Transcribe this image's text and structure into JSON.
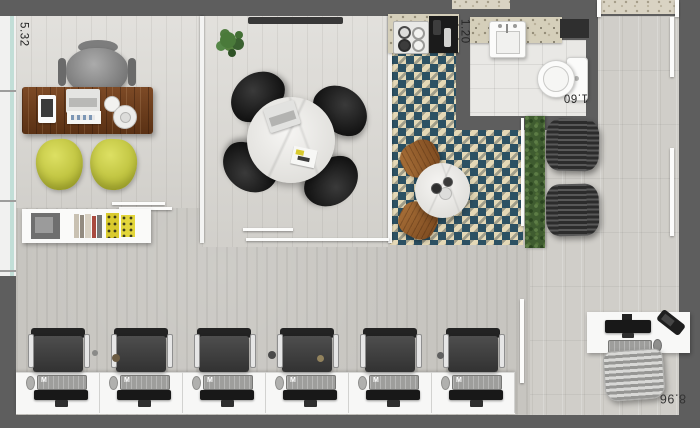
{
  "plan": {
    "type": "office-floorplan",
    "dimensions": {
      "left_room_depth": "5.32",
      "bath_width": "1.20",
      "bath_length": "1.60",
      "bottom_width": "8.96"
    },
    "workstation": {
      "count": 6,
      "keyboard_brand": "M"
    },
    "palette": {
      "wall": "#5e5e5e",
      "floor_wood": "#dad8d3",
      "floor_concrete": "#c7c5c0",
      "checker_teal": "#2c5163",
      "checker_cream": "#e4d8b6",
      "chair_yellow": "#ccd14c",
      "desk_wood": "#6e4222",
      "hedge_green": "#3f5c30"
    },
    "rooms": {
      "private_office": "private office",
      "meeting_room": "meeting room",
      "kitchen_break": "kitchen / break area",
      "bathroom": "bathroom",
      "open_office": "open office",
      "corridor": "entry corridor"
    }
  }
}
